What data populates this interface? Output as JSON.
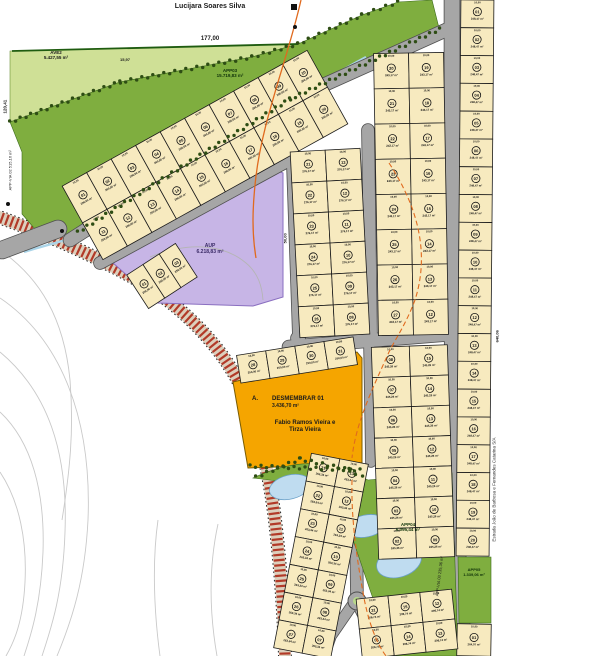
{
  "map": {
    "labels": {
      "owner_top": "Lucijara Soares Silva",
      "dim_top": "177,00",
      "dim_top_small": "15,97",
      "dim_left": "120,41",
      "dim_right": "640,06",
      "dim_purple": "50,00",
      "ave2_name": "AVE2",
      "ave2_area": "5.427,55 m²",
      "app03_name": "APP03",
      "app03_area": "15.719,83 m²",
      "aup_name": "AUP",
      "aup_area": "6.218,83 m²",
      "desm_prefix": "A.",
      "desm_name": "DESMEMBRAR 01",
      "desm_area": "3.436,70 m²",
      "desm_owner1": "Fabio Ramos Vieira e",
      "desm_owner2": "Tirza Vieira",
      "app04_name": "APP04",
      "app04_area": "6.095,44 m²",
      "app05_name": "APP05",
      "app05_area": "1.339,06 m²",
      "appvia_left": "APP-VIA 02  515,16 m²",
      "appvia_bottom": "APP-VIA 03  235,36 m²",
      "street_right": "Estrada João de Barbosa e Fernandes Catarina S/A"
    },
    "lot_defaults": {
      "front_dim": "10,00",
      "side_dim": "25,00"
    },
    "colors": {
      "light_green": "#cfe096",
      "dark_green": "#7fae3f",
      "tree": "#2e4d14",
      "lot_fill": "#f7eabf",
      "lot_border": "#1b1b1b",
      "road_fill": "#a6a6a6",
      "road_edge": "#4f4f4f",
      "purple": "#c7b5e6",
      "purple_edge": "#8a6fc0",
      "orange_area": "#f5a500",
      "orange_edge": "#7a5c00",
      "pond": "#bfdcf0",
      "pond_edge": "#6aa0c8",
      "stream": "#aad4e8",
      "dash_orange": "#e06a1e",
      "hatch_red": "#b23a28",
      "hatch_base": "#dccfbc",
      "contour": "#c9c9c9",
      "boundary_green": "#1f5c10"
    },
    "blocks": [
      {
        "id": "quadra-top-strip",
        "cx": 205,
        "cy": 155,
        "w": 280,
        "h": 84,
        "rot": -29,
        "cols": 10,
        "rows": 2,
        "area": "200,00 m²",
        "numbers": [
          "01",
          "02",
          "03",
          "04",
          "05",
          "06",
          "07",
          "08",
          "09",
          "10",
          "11",
          "12",
          "13",
          "14",
          "15",
          "16",
          "17",
          "18",
          "19",
          "20"
        ]
      },
      {
        "id": "quadra-small-west",
        "cx": 162,
        "cy": 276,
        "w": 58,
        "h": 40,
        "rot": -33,
        "cols": 3,
        "rows": 1,
        "area": "250,00 m²",
        "numbers": [
          "01",
          "02",
          "03"
        ]
      },
      {
        "id": "quadra-mid-left",
        "cx": 330,
        "cy": 243,
        "w": 70,
        "h": 186,
        "rot": -3,
        "cols": 2,
        "rows": 6,
        "area": "276,17 m²",
        "numbers": [
          "21",
          "13",
          "22",
          "12",
          "23",
          "11",
          "24",
          "10",
          "25",
          "09",
          "26",
          "08"
        ]
      },
      {
        "id": "quadra-mid-right",
        "cx": 411,
        "cy": 194,
        "w": 70,
        "h": 282,
        "rot": -1,
        "cols": 2,
        "rows": 8,
        "area": "243,17 m²",
        "numbers": [
          "20",
          "19",
          "21",
          "18",
          "22",
          "17",
          "23",
          "16",
          "24",
          "15",
          "25",
          "14",
          "26",
          "13",
          "27",
          "12"
        ]
      },
      {
        "id": "quadra-east-strip",
        "cx": 475,
        "cy": 278,
        "w": 33,
        "h": 556,
        "rot": 0.5,
        "cols": 1,
        "rows": 20,
        "area": "248,47 m²",
        "numbers": [
          "01",
          "02",
          "03",
          "04",
          "05",
          "06",
          "07",
          "08",
          "09",
          "10",
          "11",
          "12",
          "13",
          "14",
          "15",
          "16",
          "17",
          "18",
          "19",
          "20"
        ]
      },
      {
        "id": "quadra-east-strip-south",
        "cx": 474,
        "cy": 640,
        "w": 34,
        "h": 32,
        "rot": 1,
        "cols": 1,
        "rows": 1,
        "area": "264,07 m²",
        "numbers": [
          "01"
        ]
      },
      {
        "id": "quadra-above-desmembrar",
        "cx": 297,
        "cy": 360,
        "w": 118,
        "h": 28,
        "rot": -9,
        "cols": 4,
        "rows": 1,
        "area": "250,00 m²",
        "numbers": [
          "28",
          "29",
          "30",
          "31"
        ]
      },
      {
        "id": "quadra-southeast",
        "cx": 413,
        "cy": 452,
        "w": 76,
        "h": 212,
        "rot": -2,
        "cols": 2,
        "rows": 7,
        "area": "245,26 m²",
        "numbers": [
          "08",
          "15",
          "07",
          "14",
          "06",
          "13",
          "05",
          "12",
          "04",
          "11",
          "03",
          "10",
          "02",
          "09"
        ]
      },
      {
        "id": "quadra-south-strip",
        "cx": 321,
        "cy": 556,
        "w": 58,
        "h": 198,
        "rot": 11,
        "cols": 2,
        "rows": 7,
        "area": "263,34 m²",
        "numbers": [
          "21",
          "13",
          "22",
          "12",
          "23",
          "11",
          "24",
          "10",
          "25",
          "09",
          "26",
          "08",
          "27",
          "07"
        ]
      },
      {
        "id": "quadra-bottom-center",
        "cx": 407,
        "cy": 624,
        "w": 96,
        "h": 60,
        "rot": -6,
        "cols": 3,
        "rows": 2,
        "area": "206,74 m²",
        "numbers": [
          "31",
          "15",
          "12",
          "05",
          "14",
          "13"
        ]
      }
    ],
    "geometry": {
      "ave2_poly": "M10,122 L10,51 L298,44 L252,57 L120,82 Z",
      "app03_poly": "M10,122 L120,82 L252,57 L298,44 L362,15 L398,2 L432,0 L440,32 L290,102 L78,236 L62,233 L34,228 L22,214 L22,152 Z",
      "boundary_top_line": "M12,51 L298,44",
      "aup_poly": "M112,256 L268,167 L283,173 L283,297 L253,306 L158,303 L112,262 Z",
      "desm_poly": "M233,382 L357,352 L362,358 L362,464 L248,468 Z",
      "app04_poly": "M253,478 C300,456 332,462 362,477 L368,480 L452,473 L458,656 L396,656 C372,606 356,540 340,508 C322,486 287,482 253,478 Z",
      "app05_poly": "M458,557 L491,557 L491,623 L459,623 Z",
      "hatch_path": "M-4,216 Q80,246 148,286 Q214,330 244,392 Q266,446 275,520 Q283,588 285,656",
      "stream_path": "M366,57 C300,92 215,152 150,200 C102,234 62,240 24,252",
      "gray_drain_path": "M150,257 C192,240 226,246 246,263 C258,273 262,286 263,300",
      "solid_orange_path": "M301,0 C288,58 263,118 256,176 C252,210 252,234 256,258",
      "dashed_paths": [
        "M389,163 C420,210 429,256 415,300 C406,324 396,338 389,352 C372,390 356,422 352,458",
        "M352,480 C351,520 357,560 364,598 C369,624 377,644 386,656"
      ],
      "contour_paths": [
        "M0,250 C40,278 64,318 70,380 C74,430 70,470 62,520",
        "M0,298 C62,340 92,420 88,520 C85,580 72,620 57,656",
        "M0,352 C48,392 68,452 65,532 C63,592 52,626 42,656",
        "M0,412 C32,442 45,492 43,552 C41,602 32,632 24,656",
        "M0,472 C20,502 27,542 25,582 C23,622 14,642 6,656",
        "M158,520 C152,562 154,612 160,656",
        "M218,524 C208,570 210,616 217,656"
      ],
      "roads": [
        {
          "d": "M70,240 L288,101 L446,30",
          "w": 13
        },
        {
          "d": "M100,263 L293,158",
          "w": 12
        },
        {
          "d": "M291,108 L299,338",
          "w": 12
        },
        {
          "d": "M368,130 L371,338",
          "w": 12
        },
        {
          "d": "M452,0 L452,332 L456,520 L464,656",
          "w": 15
        },
        {
          "d": "M289,347 L452,334",
          "w": 13
        },
        {
          "d": "M297,338 L311,428 L341,463 L352,471 L356,520 L357,601 L371,629 L386,656",
          "w": 12
        },
        {
          "d": "M353,604 L331,636 L324,656",
          "w": 10
        },
        {
          "d": "M2,250 L58,229",
          "w": 17
        },
        {
          "d": "M369,341 L371,462",
          "w": 10
        }
      ],
      "roundabouts": [
        {
          "cx": 352,
          "cy": 471,
          "r": 9
        },
        {
          "cx": 357,
          "cy": 601,
          "r": 9
        }
      ],
      "ponds": [
        {
          "cx": 290,
          "cy": 487,
          "rx": 21,
          "ry": 12,
          "rot": -14
        },
        {
          "cx": 327,
          "cy": 507,
          "rx": 20,
          "ry": 11,
          "rot": -14
        },
        {
          "cx": 366,
          "cy": 526,
          "rx": 20,
          "ry": 11,
          "rot": -12
        },
        {
          "cx": 399,
          "cy": 562,
          "rx": 23,
          "ry": 15,
          "rot": -18
        }
      ],
      "tree_rows": [
        [
          [
            10,
            122
          ],
          [
            120,
            82
          ],
          [
            252,
            57
          ],
          [
            298,
            44
          ],
          [
            362,
            15
          ],
          [
            398,
            2
          ]
        ],
        [
          [
            78,
            232
          ],
          [
            290,
            99
          ],
          [
            440,
            29
          ]
        ],
        [
          [
            250,
            466
          ],
          [
            360,
            470
          ]
        ],
        [
          [
            256,
            477
          ],
          [
            300,
            459
          ],
          [
            350,
            470
          ],
          [
            362,
            477
          ]
        ]
      ],
      "marker_squares": [
        [
          291,
          4
        ]
      ],
      "marker_dots": [
        [
          8,
          204
        ],
        [
          62,
          231
        ],
        [
          295,
          27
        ]
      ]
    }
  }
}
